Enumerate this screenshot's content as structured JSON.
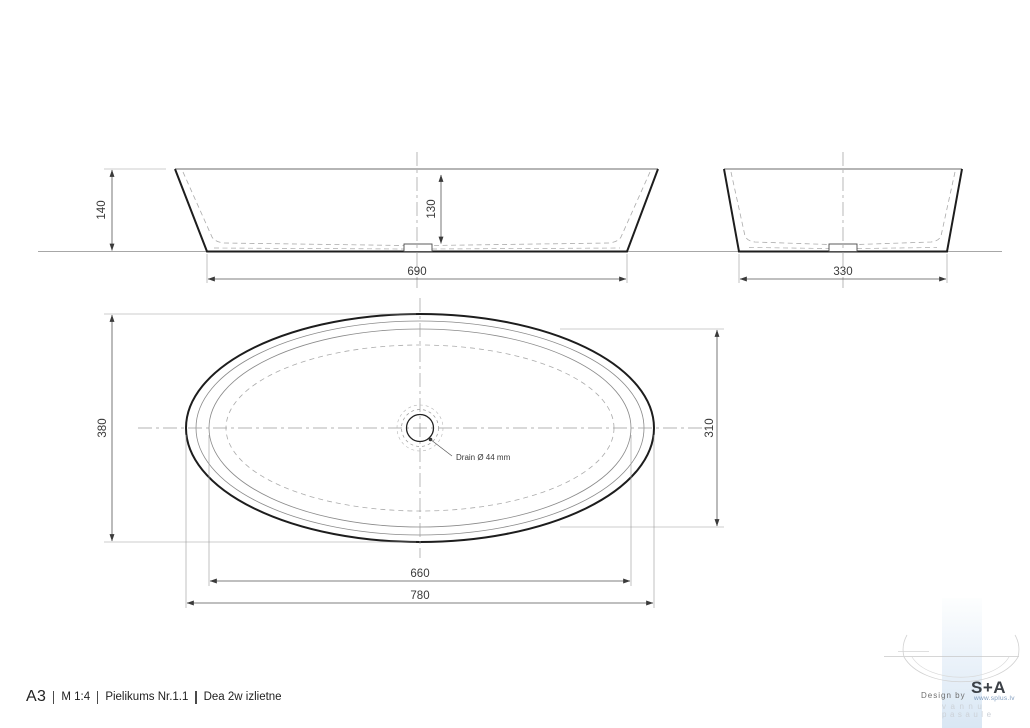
{
  "title_block": {
    "format": "A3",
    "scale": "M 1:4",
    "appendix": "Pielikums Nr.1.1",
    "product": "Dea 2w izlietne"
  },
  "front_view": {
    "overall_height": "140",
    "basin_depth": "130",
    "base_width": "690"
  },
  "side_view": {
    "base_width": "330"
  },
  "top_view": {
    "overall_length": "780",
    "overall_width": "380",
    "inner_length": "660",
    "inner_width": "310",
    "drain_label": "Drain Ø 44 mm"
  },
  "branding": {
    "design_by": "Design by",
    "logo_text": "S+A",
    "website": "www.splus.lv",
    "tagline_word1": "vannu",
    "tagline_word2": "pasaule"
  },
  "colors": {
    "outline_dark": "#1d1d1d",
    "outline_thin": "#6b6b6b",
    "hidden_dashed": "#ababab",
    "centerline": "#9a9a9a",
    "dimension_line": "#555555",
    "dimension_text": "#3a3a3a",
    "logo_band_top": "#fdfefe",
    "logo_band_bottom": "#d9e7f4",
    "logo_text_color": "#3c4147",
    "watermark_gray": "#d2d2d2"
  }
}
